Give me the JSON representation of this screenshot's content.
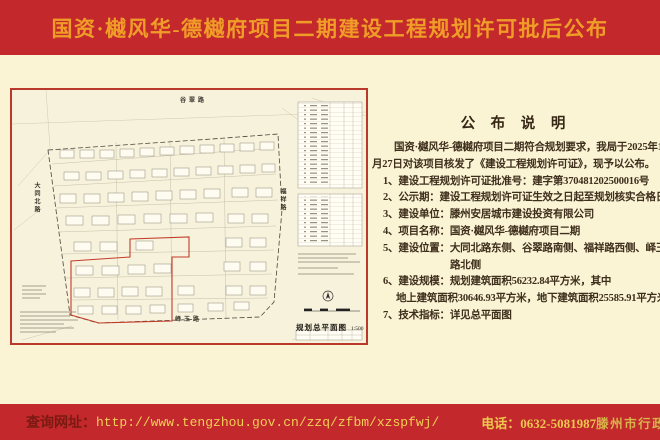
{
  "poster": {
    "title": "国资·樾风华-德樾府项目二期建设工程规划许可批后公布"
  },
  "map": {
    "roads": {
      "top": "谷翠路",
      "left": "大同北路",
      "right": "福祥路",
      "bottom": "峄玉路"
    },
    "caption": "规划总平面图",
    "scale": "1:500"
  },
  "announcement": {
    "heading": "公 布 说 明",
    "lines": [
      "国资·樾风华-德樾府项目二期符合规划要求，我局于2025年1",
      "月27日对该项目核发了《建设工程规划许可证》，现予以公布。",
      "1、建设工程规划许可证批准号：建字第370481202500016号",
      "2、公示期：建设工程规划许可证生效之日起至规划核实合格日",
      "3、建设单位：滕州安居城市建设投资有限公司",
      "4、项目名称：国资·樾风华-德樾府项目二期",
      "5、建设位置：大同北路东侧、谷翠路南侧、福祥路西侧、峄玉",
      "路北侧",
      "6、建设规模：规划建筑面积56232.84平方米，其中",
      "地上建筑面积30646.93平方米，地下建筑面积25585.91平方米。",
      "7、技术指标：详见总平面图"
    ]
  },
  "footer": {
    "url_label": "查询网址：",
    "url": "http://www.tengzhou.gov.cn/zzq/zfbm/xzspfwj/",
    "phone": "电话：0632-5081987",
    "producer": "滕州市行政审批服务局监制"
  },
  "colors": {
    "banner_red": "#c2282c",
    "body_cream": "#faf4d5",
    "title_gold": "#f09d28",
    "map_border_red": "#b93a2b",
    "body_text_brown": "#3e2e1c",
    "footer_yellow": "#f2cf55"
  }
}
